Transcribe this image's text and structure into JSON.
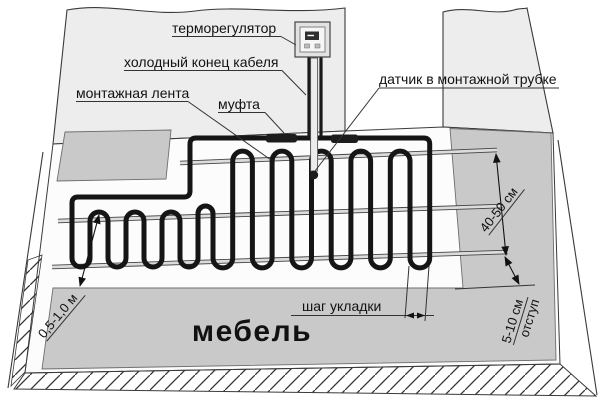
{
  "labels": {
    "thermostat": "терморегулятор",
    "cold_cable_end": "холодный конец кабеля",
    "mounting_tape": "монтажная лента",
    "coupling": "муфта",
    "sensor_in_tube": "датчик в монтажной трубке",
    "laying_step": "шаг укладки",
    "furniture": "мебель"
  },
  "dimensions": {
    "tape_spacing": "40-50 см",
    "edge_offset_value": "5-10 см",
    "edge_offset_word": "отступ",
    "furniture_clearance": "0,5-1,0 м"
  },
  "colors": {
    "wall": "#ededed",
    "floor": "#fcfcfc",
    "zone_gray": "#c9c9c9",
    "cable": "#151515",
    "line": "#333333",
    "tape_light": "#dcdcdc"
  }
}
